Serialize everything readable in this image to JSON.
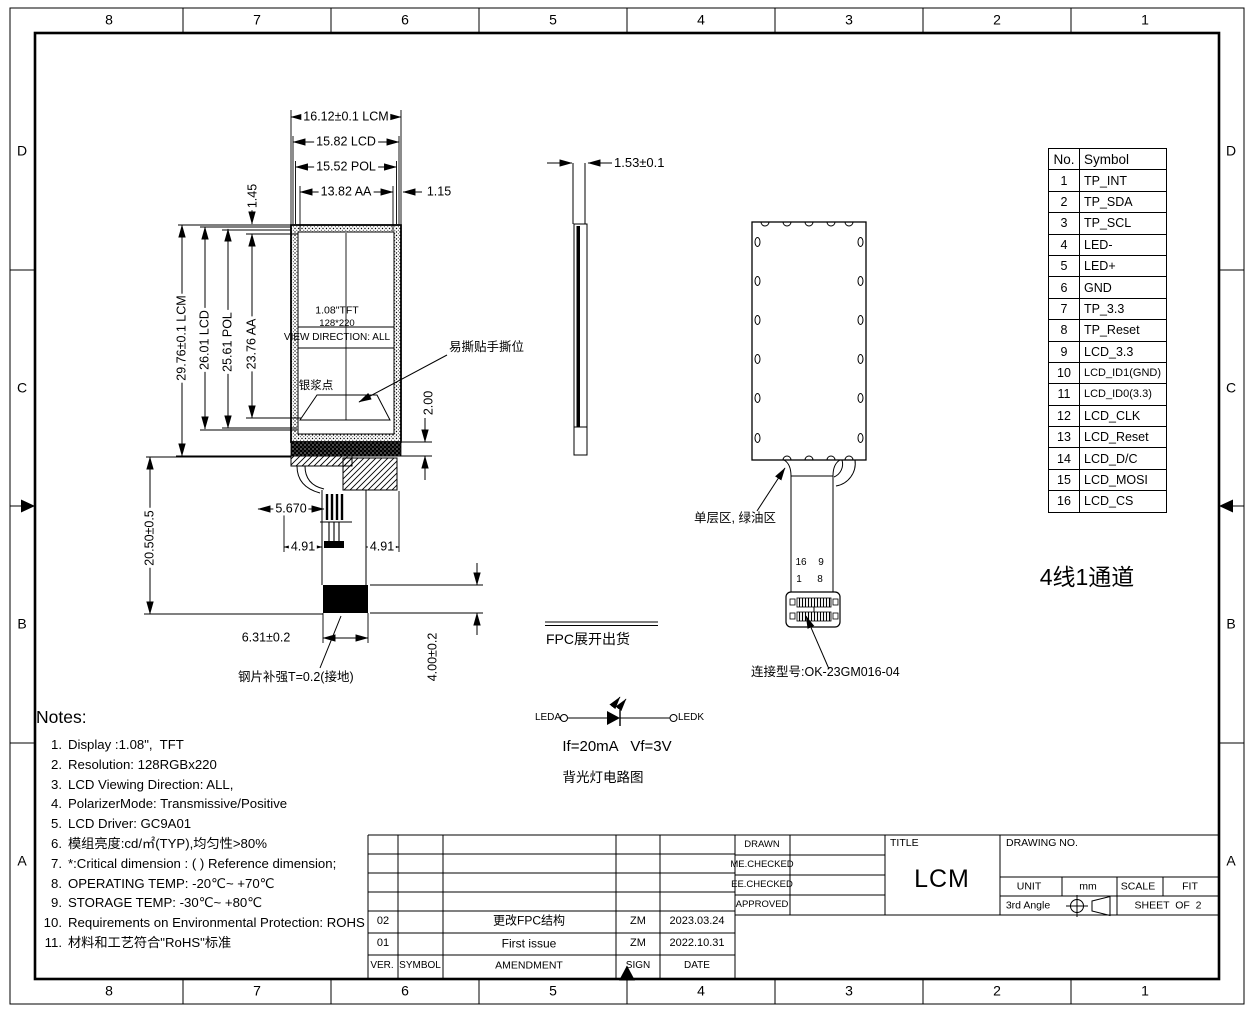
{
  "zones": {
    "cols": [
      "8",
      "7",
      "6",
      "5",
      "4",
      "3",
      "2",
      "1"
    ],
    "rows": [
      "D",
      "C",
      "B",
      "A"
    ]
  },
  "front": {
    "dim_top_lcm": "16.12±0.1 LCM",
    "dim_top_lcd": "15.82 LCD",
    "dim_top_pol": "15.52 POL",
    "dim_top_aa": "13.82 AA",
    "dim_115": "1.15",
    "dim_145": "1.45",
    "dim_left_lcm": "29.76±0.1 LCM",
    "dim_left_lcd": "26.01 LCD",
    "dim_left_pol": "25.61 POL",
    "dim_left_aa": "23.76 AA",
    "dim_2050": "20.50±0.5",
    "dim_200": "2.00",
    "dim_5670": "5.670",
    "dim_491_left": "4.91",
    "dim_491_right": "4.91",
    "dim_631": "6.31±0.2",
    "dim_400": "4.00±0.2",
    "tft": "1.08\"TFT",
    "res": "128*220",
    "view_dir": "VIEW DIRECTION: ALL",
    "silver_dot": "银浆点",
    "tear_tab": "易撕贴手撕位",
    "stiffener": "钢片补强T=0.2(接地)"
  },
  "side": {
    "dim_153": "1.53±0.1"
  },
  "back": {
    "single_layer": "单层区, 绿油区",
    "p16": "16",
    "p9": "9",
    "p1": "1",
    "p8": "8",
    "connector": "连接型号:OK-23GM016-04"
  },
  "fpc_note": "FPC展开出货",
  "channel_note": "4线1通道",
  "circuit": {
    "leda": "LEDA",
    "ledk": "LEDK",
    "spec": "If=20mA   Vf=3V",
    "caption": "背光灯电路图"
  },
  "pin_table": {
    "headers": {
      "no": "No.",
      "symbol": "Symbol"
    },
    "rows": [
      {
        "no": "1",
        "symbol": "TP_INT"
      },
      {
        "no": "2",
        "symbol": "TP_SDA"
      },
      {
        "no": "3",
        "symbol": "TP_SCL"
      },
      {
        "no": "4",
        "symbol": "LED-"
      },
      {
        "no": "5",
        "symbol": "LED+"
      },
      {
        "no": "6",
        "symbol": "GND"
      },
      {
        "no": "7",
        "symbol": "TP_3.3"
      },
      {
        "no": "8",
        "symbol": "TP_Reset"
      },
      {
        "no": "9",
        "symbol": "LCD_3.3"
      },
      {
        "no": "10",
        "symbol": "LCD_ID1(GND)"
      },
      {
        "no": "11",
        "symbol": "LCD_ID0(3.3)"
      },
      {
        "no": "12",
        "symbol": "LCD_CLK"
      },
      {
        "no": "13",
        "symbol": "LCD_Reset"
      },
      {
        "no": "14",
        "symbol": "LCD_D/C"
      },
      {
        "no": "15",
        "symbol": "LCD_MOSI"
      },
      {
        "no": "16",
        "symbol": "LCD_CS"
      }
    ]
  },
  "notes": {
    "title": "Notes:",
    "items": [
      {
        "no": "1.",
        "text": "Display :1.08\",  TFT"
      },
      {
        "no": "2.",
        "text": "Resolution: 128RGBx220"
      },
      {
        "no": "3.",
        "text": "LCD Viewing Direction: ALL,"
      },
      {
        "no": "4.",
        "text": "PolarizerMode: Transmissive/Positive"
      },
      {
        "no": "5.",
        "text": "LCD Driver: GC9A01"
      },
      {
        "no": "6.",
        "text": "模组亮度:cd/㎡(TYP),均匀性>80%"
      },
      {
        "no": "7.",
        "text": "*:Critical dimension : ( ) Reference dimension;"
      },
      {
        "no": "8.",
        "text": "OPERATING TEMP: -20℃~ +70℃"
      },
      {
        "no": "9.",
        "text": "STORAGE TEMP: -30℃~ +80℃"
      },
      {
        "no": "10.",
        "text": "Requirements on Environmental Protection: ROHS"
      },
      {
        "no": "11.",
        "text": "材料和工艺符合\"RoHS\"标准"
      }
    ]
  },
  "title_block": {
    "drawn": "DRAWN",
    "me_checked": "ME.CHECKED",
    "ee_checked": "EE.CHECKED",
    "approved": "APPROVED",
    "title_label": "TITLE",
    "title_value": "LCM",
    "drawing_no": "DRAWING NO.",
    "unit_label": "UNIT",
    "unit_value": "mm",
    "scale_label": "SCALE",
    "scale_value": "FIT",
    "angle": "3rd Angle",
    "sheet": "SHEET  OF  2",
    "rev_headers": {
      "ver": "VER.",
      "symbol": "SYMBOL",
      "amendment": "AMENDMENT",
      "sign": "SIGN",
      "date": "DATE"
    },
    "revisions": [
      {
        "ver": "02",
        "symbol": "",
        "amendment": "更改FPC结构",
        "sign": "ZM",
        "date": "2023.03.24"
      },
      {
        "ver": "01",
        "symbol": "",
        "amendment": "First issue",
        "sign": "ZM",
        "date": "2022.10.31"
      }
    ]
  }
}
